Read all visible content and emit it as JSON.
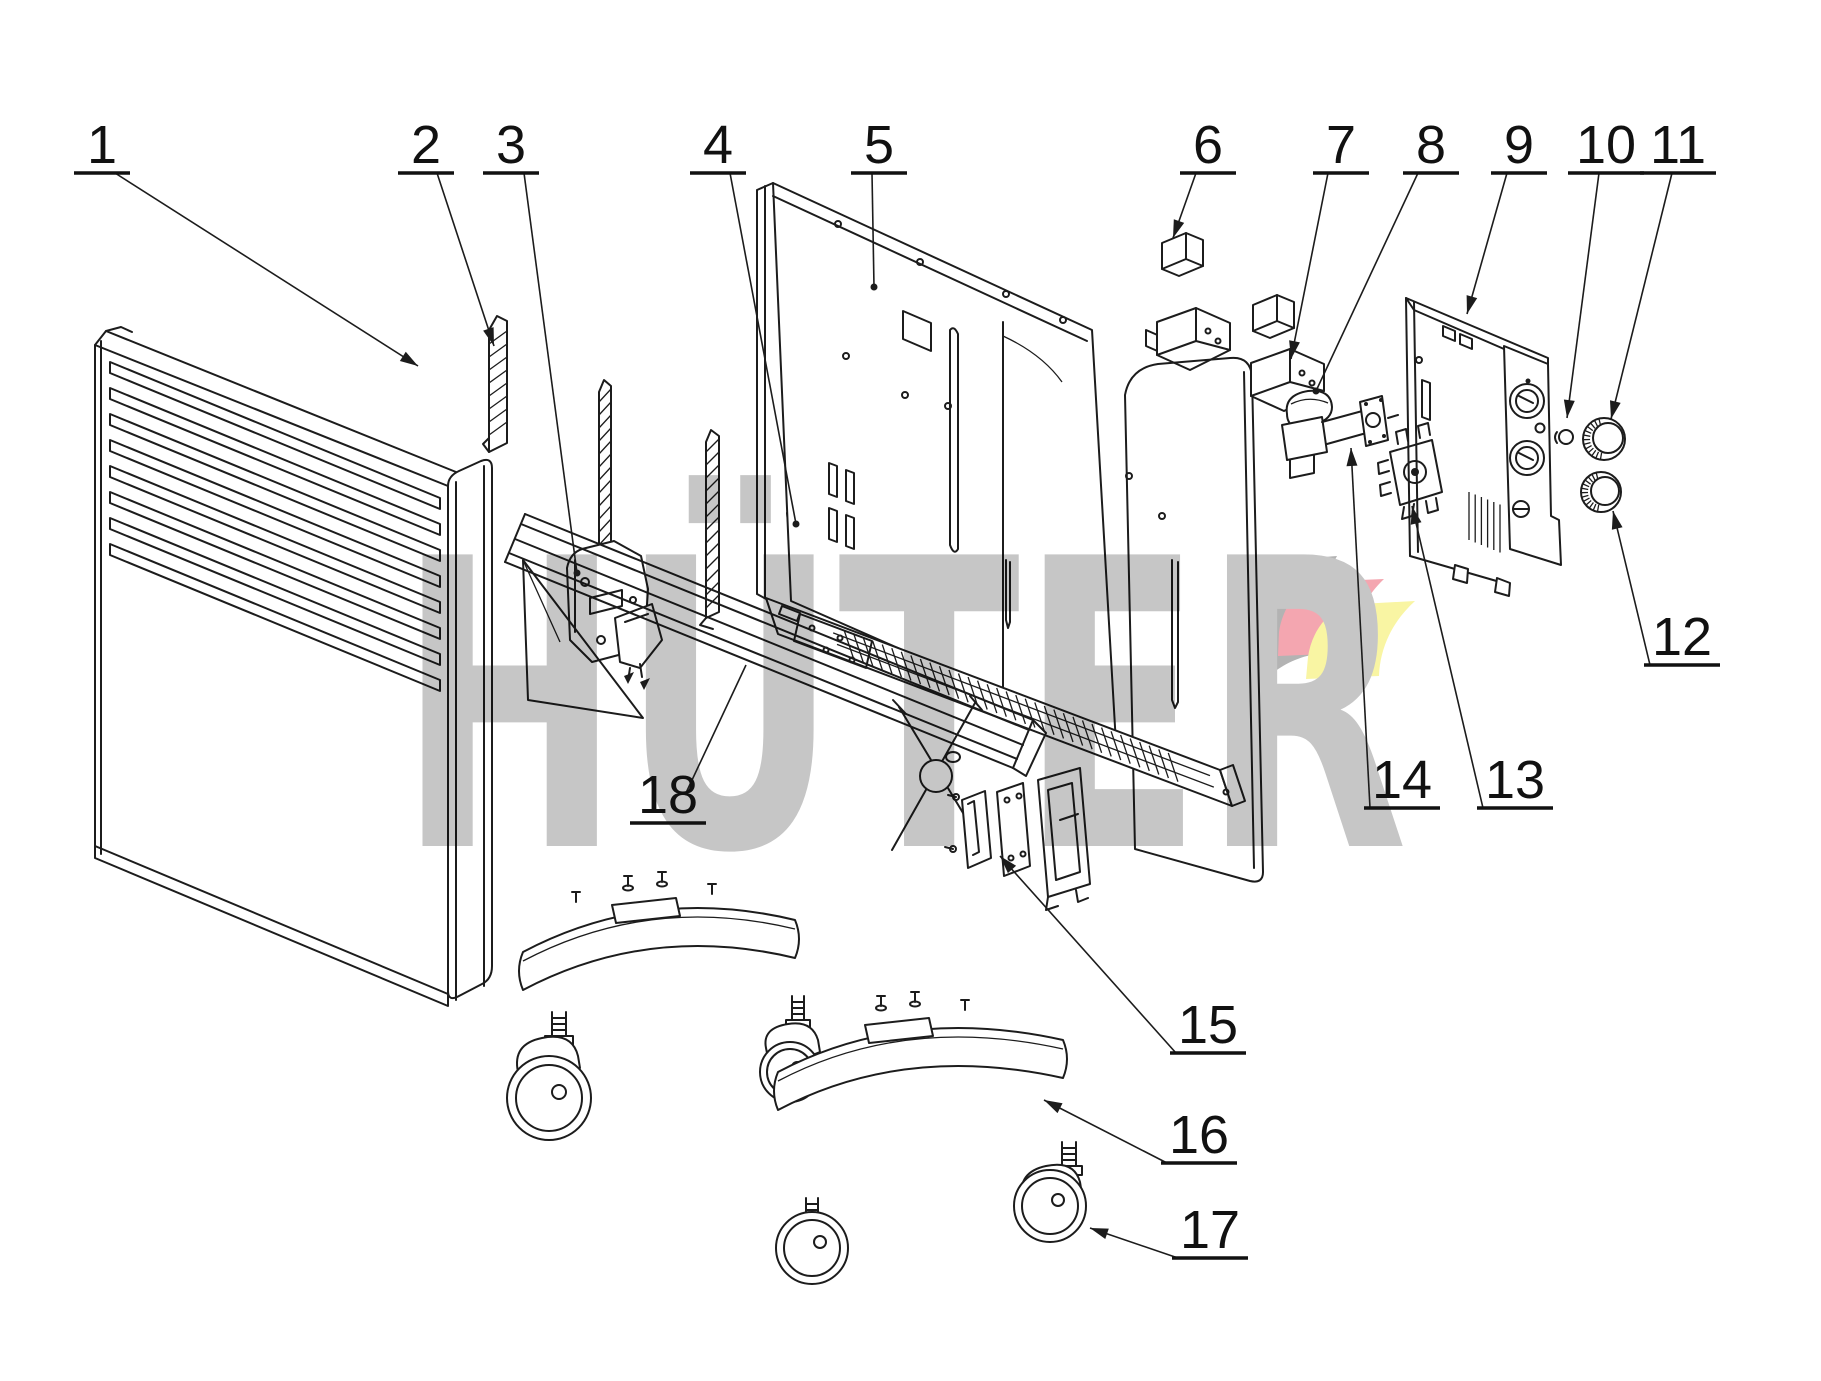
{
  "diagram": {
    "type": "exploded-parts-diagram",
    "subject": "convector heater",
    "background": "#ffffff",
    "line_color": "#1c1c1c",
    "watermark": {
      "text": "HÜTER",
      "color": "#c6c6c6"
    },
    "logo": {
      "gray": "#b3b3b3",
      "red": "#f4a6b0",
      "yellow": "#f9f5a3"
    },
    "callouts": [
      {
        "label": "1",
        "x": 102,
        "y": 163,
        "sx": 115,
        "sy": 173,
        "ex": 418,
        "ey": 366,
        "tip": "arrow",
        "part": "front-panel"
      },
      {
        "label": "2",
        "x": 426,
        "y": 163,
        "sx": 437,
        "sy": 173,
        "ex": 494,
        "ey": 346,
        "tip": "arrow",
        "part": "trim-strip"
      },
      {
        "label": "3",
        "x": 511,
        "y": 163,
        "sx": 524,
        "sy": 173,
        "ex": 577,
        "ey": 573,
        "tip": "dot",
        "part": "hinge-bracket"
      },
      {
        "label": "4",
        "x": 718,
        "y": 163,
        "sx": 730,
        "sy": 173,
        "ex": 796,
        "ey": 524,
        "tip": "dot",
        "part": "switch-box"
      },
      {
        "label": "5",
        "x": 879,
        "y": 163,
        "sx": 872,
        "sy": 173,
        "ex": 874,
        "ey": 287,
        "tip": "dot",
        "part": "back-panel"
      },
      {
        "label": "6",
        "x": 1208,
        "y": 163,
        "sx": 1196,
        "sy": 173,
        "ex": 1173,
        "ey": 238,
        "tip": "arrow",
        "part": "wall-bracket-a"
      },
      {
        "label": "7",
        "x": 1341,
        "y": 163,
        "sx": 1328,
        "sy": 173,
        "ex": 1291,
        "ey": 359,
        "tip": "arrow",
        "part": "wall-bracket-b"
      },
      {
        "label": "8",
        "x": 1431,
        "y": 163,
        "sx": 1418,
        "sy": 173,
        "ex": 1316,
        "ey": 391,
        "tip": "dot",
        "part": "thermostat"
      },
      {
        "label": "9",
        "x": 1519,
        "y": 163,
        "sx": 1507,
        "sy": 173,
        "ex": 1467,
        "ey": 314,
        "tip": "arrow",
        "part": "control-bracket"
      },
      {
        "label": "10",
        "x": 1606,
        "y": 163,
        "sx": 1599,
        "sy": 173,
        "ex": 1567,
        "ey": 418,
        "tip": "arrow",
        "part": "indicator-cap"
      },
      {
        "label": "11",
        "x": 1678,
        "y": 163,
        "sx": 1672,
        "sy": 173,
        "ex": 1611,
        "ey": 419,
        "tip": "arrow",
        "part": "knob-upper"
      },
      {
        "label": "12",
        "x": 1682,
        "y": 655,
        "sx": 1650,
        "sy": 665,
        "ex": 1613,
        "ey": 511,
        "tip": "arrow",
        "part": "knob-lower"
      },
      {
        "label": "13",
        "x": 1515,
        "y": 798,
        "sx": 1483,
        "sy": 808,
        "ex": 1412,
        "ey": 506,
        "tip": "arrow",
        "part": "rotary-switch"
      },
      {
        "label": "14",
        "x": 1402,
        "y": 798,
        "sx": 1370,
        "sy": 808,
        "ex": 1351,
        "ey": 448,
        "tip": "arrow",
        "part": "thermostat-terminal"
      },
      {
        "label": "15",
        "x": 1208,
        "y": 1043,
        "sx": 1176,
        "sy": 1053,
        "ex": 1000,
        "ey": 856,
        "tip": "arrow",
        "part": "fixing-bracket"
      },
      {
        "label": "16",
        "x": 1199,
        "y": 1153,
        "sx": 1167,
        "sy": 1163,
        "ex": 1044,
        "ey": 1100,
        "tip": "arrow",
        "part": "foot"
      },
      {
        "label": "17",
        "x": 1210,
        "y": 1248,
        "sx": 1178,
        "sy": 1258,
        "ex": 1090,
        "ey": 1228,
        "tip": "arrow",
        "part": "caster"
      },
      {
        "label": "18",
        "x": 668,
        "y": 813,
        "sx": 685,
        "sy": 795,
        "ex": 746,
        "ey": 665,
        "tip": "none",
        "part": "air-deflector"
      }
    ]
  }
}
